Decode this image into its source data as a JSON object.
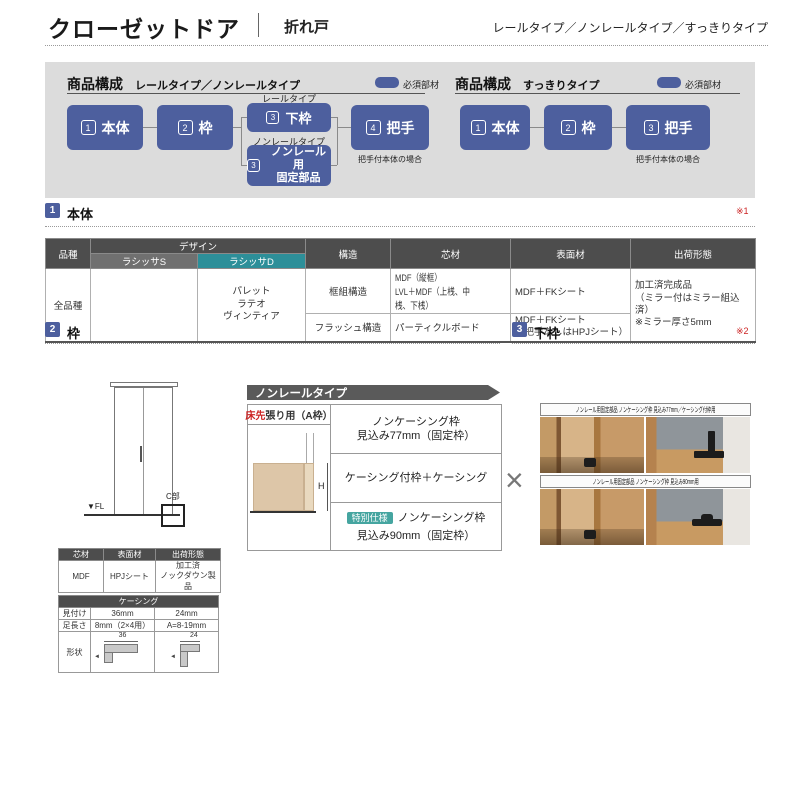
{
  "colors": {
    "accent_blue": "#4d5f9e",
    "teal_header": "#2d8f99",
    "teal_badge": "#45a5a0",
    "dark_header": "#4d4d4d",
    "panel_gray": "#dcdcdc",
    "banner_gray": "#5a5a5a",
    "note_red": "#cc2222"
  },
  "header": {
    "title": "クローゼットドア",
    "subtitle": "折れ戸",
    "types": "レールタイプ／ノンレールタイプ／すっきりタイプ"
  },
  "comp_left": {
    "title": "商品構成",
    "subtitle": "レールタイプ／ノンレールタイプ",
    "legend": "必須部材",
    "box1_num": "1",
    "box1_label": "本体",
    "box2_num": "2",
    "box2_label": "枠",
    "rail_label": "レールタイプ",
    "box3a_num": "3",
    "box3a_label": "下枠",
    "nonrail_label": "ノンレールタイプ",
    "box3b_num": "3",
    "box3b_label": "ノンレール用\n固定部品",
    "box4_num": "4",
    "box4_label": "把手",
    "note": "把手付本体の場合"
  },
  "comp_right": {
    "title": "商品構成",
    "subtitle": "すっきりタイプ",
    "legend": "必須部材",
    "box1_num": "1",
    "box1_label": "本体",
    "box2_num": "2",
    "box2_label": "枠",
    "box3_num": "3",
    "box3_label": "把手",
    "note": "把手付本体の場合"
  },
  "sec1": {
    "num": "1",
    "title": "本体",
    "ref": "※1"
  },
  "sec2": {
    "num": "2",
    "title": "枠"
  },
  "sec3": {
    "num": "3",
    "title": "下枠",
    "ref": "※2"
  },
  "main_table": {
    "h_hinshu": "品種",
    "h_design": "デザイン",
    "h_s": "ラシッサS",
    "h_d": "ラシッサD",
    "h_kozo": "構造",
    "h_shin": "芯材",
    "h_hyo": "表面材",
    "h_shukka": "出荷形態",
    "hinshu": "全品種",
    "s_items": "",
    "d_items": "パレット\nラテオ\nヴィンティア",
    "r1_kozo": "框組構造",
    "r1_shin": "MDF（縦框）\nLVL＋MDF（上桟、中桟、下桟）",
    "r1_hyo": "MDF＋FKシート",
    "r2_kozo": "フラッシュ構造",
    "r2_shin": "パーティクルボード",
    "r2_hyo": "MDF＋FKシート\n（把手なしはHPJシート）",
    "shukka": "加工済完成品\n（ミラー付はミラー組込済）\n※ミラー厚さ5mm"
  },
  "door": {
    "fl": "▼FL",
    "c": "C部"
  },
  "nonrail": {
    "banner": "ノンレールタイプ",
    "head_red": "床先",
    "head_rest": "張り用（A枠）",
    "h_dim": "H",
    "row1": "ノンケーシング枠\n見込み77mm（固定枠）",
    "row2": "ケーシング付枠＋ケーシング",
    "row3_badge": "特別仕様",
    "row3_line1": "ノンケーシング枠",
    "row3_line2": "見込み90mm（固定枠）",
    "cross": "×"
  },
  "photos": {
    "caption1": "ノンレール用固定部品 ノンケーシング枠 見込み77mm／ケーシング付枠用",
    "caption2": "ノンレール用固定部品 ノンケーシング枠 見込み90mm用"
  },
  "mat_table": {
    "h1": "芯材",
    "h2": "表面材",
    "h3": "出荷形態",
    "v1": "MDF",
    "v2": "HPJシート",
    "v3": "加工済\nノックダウン製品"
  },
  "casing": {
    "title": "ケーシング",
    "r1_label": "見付け",
    "r1_v1": "36mm",
    "r1_v2": "24mm",
    "r2_label": "足長さ",
    "r2_v1": "8mm（2×4用）",
    "r2_v2": "A=8-19mm",
    "r3_label": "形状",
    "dim1": "36",
    "dim2": "24"
  }
}
